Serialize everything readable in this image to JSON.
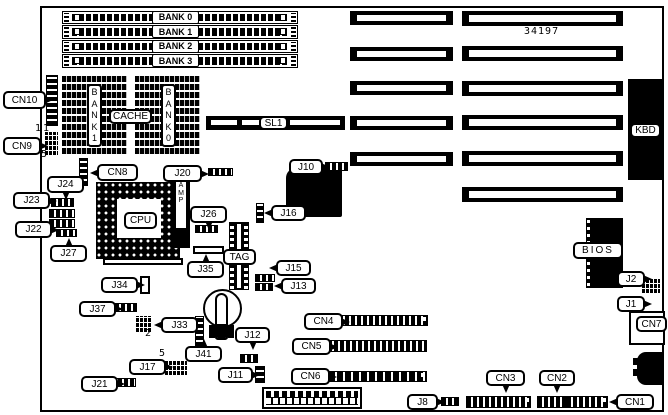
{
  "title": "motherboard-layout-diagram",
  "part_number": "34197",
  "board_labels": {
    "cache_bank_left": "B\nA\nN\nK\n1",
    "cache_bank_right": "B\nA\nN\nK\n0",
    "amp": "A\nM\nP"
  },
  "simm": {
    "x": 62,
    "w": 236,
    "h": 13.5,
    "ys": [
      10.5,
      25,
      39.5,
      54
    ],
    "labels": [
      "BANK 0",
      "BANK 1",
      "BANK 2",
      "BANK 3"
    ]
  },
  "isa_slots": {
    "columns": [
      {
        "side": "left",
        "x": 350,
        "w": 103,
        "h": 14,
        "ys": [
          11,
          46.5,
          81,
          115.5,
          151.5
        ]
      },
      {
        "side": "right",
        "x": 462,
        "w": 161,
        "h": 15,
        "ys": [
          11,
          46,
          81,
          115,
          151,
          187
        ]
      }
    ]
  },
  "callouts": [
    {
      "text": "CN10",
      "x": 3,
      "y": 91,
      "w": 43,
      "h": 18,
      "tail": "r"
    },
    {
      "text": "CN9",
      "x": 3,
      "y": 137,
      "w": 38,
      "h": 18,
      "tail": "r"
    },
    {
      "text": "CN8",
      "x": 97,
      "y": 164,
      "w": 41,
      "h": 17,
      "tail": "l"
    },
    {
      "text": "J20",
      "x": 163,
      "y": 165,
      "w": 39,
      "h": 17,
      "tail": "r"
    },
    {
      "text": "J24",
      "x": 47,
      "y": 176,
      "w": 37,
      "h": 17,
      "tail": "b"
    },
    {
      "text": "J23",
      "x": 13,
      "y": 192,
      "w": 37,
      "h": 17,
      "tail": "r"
    },
    {
      "text": "J22",
      "x": 15,
      "y": 221,
      "w": 37,
      "h": 17,
      "tail": "r"
    },
    {
      "text": "J27",
      "x": 50,
      "y": 245,
      "w": 37,
      "h": 17,
      "tail": "t"
    },
    {
      "text": "J26",
      "x": 190,
      "y": 206,
      "w": 37,
      "h": 17,
      "tail": "b"
    },
    {
      "text": "J35",
      "x": 187,
      "y": 261,
      "w": 37,
      "h": 17,
      "tail": "t"
    },
    {
      "text": "J34",
      "x": 101,
      "y": 277,
      "w": 37,
      "h": 16,
      "tail": "r"
    },
    {
      "text": "J37",
      "x": 79,
      "y": 301,
      "w": 37,
      "h": 16,
      "tail": "r"
    },
    {
      "text": "J33",
      "x": 161,
      "y": 317,
      "w": 37,
      "h": 16,
      "tail": "l"
    },
    {
      "text": "J41",
      "x": 185,
      "y": 346,
      "w": 37,
      "h": 16,
      "tail": "t"
    },
    {
      "text": "J17",
      "x": 129,
      "y": 359,
      "w": 37,
      "h": 16,
      "tail": "r"
    },
    {
      "text": "J21",
      "x": 81,
      "y": 376,
      "w": 37,
      "h": 16,
      "tail": "r"
    },
    {
      "text": "J12",
      "x": 235,
      "y": 327,
      "w": 35,
      "h": 16,
      "tail": "b"
    },
    {
      "text": "J11",
      "x": 218,
      "y": 367,
      "w": 35,
      "h": 16,
      "tail": "r"
    },
    {
      "text": "J10",
      "x": 289,
      "y": 159,
      "w": 34,
      "h": 16,
      "tail": "r"
    },
    {
      "text": "J16",
      "x": 271,
      "y": 205,
      "w": 35,
      "h": 16,
      "tail": "l"
    },
    {
      "text": "J15",
      "x": 276,
      "y": 260,
      "w": 35,
      "h": 16,
      "tail": "l"
    },
    {
      "text": "J13",
      "x": 281,
      "y": 278,
      "w": 35,
      "h": 16,
      "tail": "l"
    },
    {
      "text": "CN4",
      "x": 304,
      "y": 313,
      "w": 39,
      "h": 17,
      "tail": "r"
    },
    {
      "text": "CN5",
      "x": 292,
      "y": 338,
      "w": 39,
      "h": 17,
      "tail": "r"
    },
    {
      "text": "CN6",
      "x": 291,
      "y": 368,
      "w": 39,
      "h": 17,
      "tail": "r"
    },
    {
      "text": "J8",
      "x": 407,
      "y": 394,
      "w": 31,
      "h": 16,
      "tail": "r"
    },
    {
      "text": "CN3",
      "x": 486,
      "y": 370,
      "w": 39,
      "h": 16,
      "tail": "b"
    },
    {
      "text": "CN2",
      "x": 539,
      "y": 370,
      "w": 36,
      "h": 16,
      "tail": "b"
    },
    {
      "text": "CN1",
      "x": 616,
      "y": 394,
      "w": 38,
      "h": 16,
      "tail": "l"
    },
    {
      "text": "J2",
      "x": 617,
      "y": 271,
      "w": 28,
      "h": 16,
      "tail": "r"
    },
    {
      "text": "J1",
      "x": 617,
      "y": 296,
      "w": 28,
      "h": 16,
      "tail": "r"
    },
    {
      "text": "CN7",
      "x": 636,
      "y": 316,
      "w": 31,
      "h": 16,
      "tail": "none"
    },
    {
      "text": "CPU",
      "x": 124,
      "y": 212,
      "w": 33,
      "h": 17,
      "tail": "none"
    },
    {
      "text": "CACHE",
      "x": 109,
      "y": 109,
      "w": 43,
      "h": 15,
      "tail": "none"
    },
    {
      "text": "TAG",
      "x": 223,
      "y": 249,
      "w": 33,
      "h": 16,
      "tail": "none"
    },
    {
      "text": "SL1",
      "x": 259,
      "y": 116,
      "w": 29,
      "h": 14,
      "tail": "none"
    },
    {
      "text": "KBD",
      "x": 630,
      "y": 123,
      "w": 31,
      "h": 15,
      "tail": "none"
    },
    {
      "text": "BIOS",
      "x": 573,
      "y": 242,
      "w": 50,
      "h": 17,
      "tail": "none",
      "ls": 2
    }
  ],
  "connectors": [
    {
      "name": "cn10-pins",
      "p": "vticks",
      "x": 46,
      "y": 75,
      "w": 12,
      "h": 51
    },
    {
      "name": "cn9-pins",
      "p": "grid",
      "x": 45,
      "y": 132,
      "w": 13,
      "h": 23
    },
    {
      "name": "cn8-pins",
      "p": "vticks",
      "x": 79,
      "y": 158,
      "w": 9,
      "h": 28
    },
    {
      "name": "j20-pins",
      "p": "hticks",
      "x": 208,
      "y": 168,
      "w": 25,
      "h": 8
    },
    {
      "name": "j24-pins",
      "p": "hticks",
      "x": 51,
      "y": 198,
      "w": 23,
      "h": 9
    },
    {
      "name": "j23-pins",
      "p": "hticks",
      "x": 49,
      "y": 209,
      "w": 26,
      "h": 9
    },
    {
      "name": "j22-pins",
      "p": "hticks",
      "x": 49,
      "y": 219,
      "w": 26,
      "h": 9
    },
    {
      "name": "j27-pins",
      "p": "hticks",
      "x": 56,
      "y": 229,
      "w": 21,
      "h": 8
    },
    {
      "name": "j26-pins",
      "p": "hticks",
      "x": 195,
      "y": 225,
      "w": 23,
      "h": 8
    },
    {
      "name": "j35-pins",
      "p": "outline",
      "x": 193,
      "y": 246,
      "w": 31,
      "h": 8
    },
    {
      "name": "j34-pins",
      "p": "outline",
      "x": 140,
      "y": 276,
      "w": 10,
      "h": 18
    },
    {
      "name": "j37-pins",
      "p": "hticks",
      "x": 114,
      "y": 303,
      "w": 23,
      "h": 9
    },
    {
      "name": "j33-pins",
      "p": "grid",
      "x": 136,
      "y": 316,
      "w": 15,
      "h": 16
    },
    {
      "name": "j41-pins",
      "p": "vticks",
      "x": 195,
      "y": 316,
      "w": 9,
      "h": 31
    },
    {
      "name": "j17-pins",
      "p": "grid",
      "x": 165,
      "y": 360,
      "w": 22,
      "h": 15
    },
    {
      "name": "j21-pins",
      "p": "hticks",
      "x": 111,
      "y": 378,
      "w": 25,
      "h": 9
    },
    {
      "name": "j12-pins",
      "p": "hticks",
      "x": 240,
      "y": 354,
      "w": 18,
      "h": 9
    },
    {
      "name": "j11-pins",
      "p": "vticks",
      "x": 255,
      "y": 366,
      "w": 10,
      "h": 17
    },
    {
      "name": "j10-pins",
      "p": "hticks",
      "x": 325,
      "y": 162,
      "w": 23,
      "h": 9
    },
    {
      "name": "j16-pins",
      "p": "vticks",
      "x": 256,
      "y": 203,
      "w": 8,
      "h": 20
    },
    {
      "name": "j15-pins",
      "p": "hticks",
      "x": 255,
      "y": 274,
      "w": 20,
      "h": 8
    },
    {
      "name": "j13-pins",
      "p": "hticks",
      "x": 255,
      "y": 283,
      "w": 18,
      "h": 8
    },
    {
      "name": "cn4-pins",
      "p": "hticks",
      "x": 338,
      "y": 315,
      "w": 90,
      "h": 11,
      "cap": true
    },
    {
      "name": "cn5-pins",
      "p": "hticks",
      "x": 321,
      "y": 340,
      "w": 106,
      "h": 12
    },
    {
      "name": "cn6-pins",
      "p": "hticks-sparse",
      "x": 328,
      "y": 371,
      "w": 99,
      "h": 11,
      "cap": true
    },
    {
      "name": "j8-pins",
      "p": "hticks",
      "x": 441,
      "y": 397,
      "w": 18,
      "h": 9
    },
    {
      "name": "cn3-pins",
      "p": "hticks",
      "x": 466,
      "y": 396,
      "w": 65,
      "h": 12,
      "cap": true
    },
    {
      "name": "cn2-pins",
      "p": "hticks",
      "x": 537,
      "y": 396,
      "w": 29,
      "h": 12
    },
    {
      "name": "cn1-pins",
      "p": "hticks",
      "x": 566,
      "y": 396,
      "w": 42,
      "h": 12,
      "cap": true
    },
    {
      "name": "j2-j1-pins",
      "p": "grid",
      "x": 642,
      "y": 278,
      "w": 18,
      "h": 15
    }
  ],
  "pin_markers": [
    {
      "text": "1",
      "x": 35,
      "y": 123
    },
    {
      "text": "1",
      "x": 43,
      "y": 123
    },
    {
      "text": "5",
      "x": 41,
      "y": 149
    },
    {
      "text": "2",
      "x": 145,
      "y": 328
    },
    {
      "text": "5",
      "x": 159,
      "y": 348
    }
  ]
}
